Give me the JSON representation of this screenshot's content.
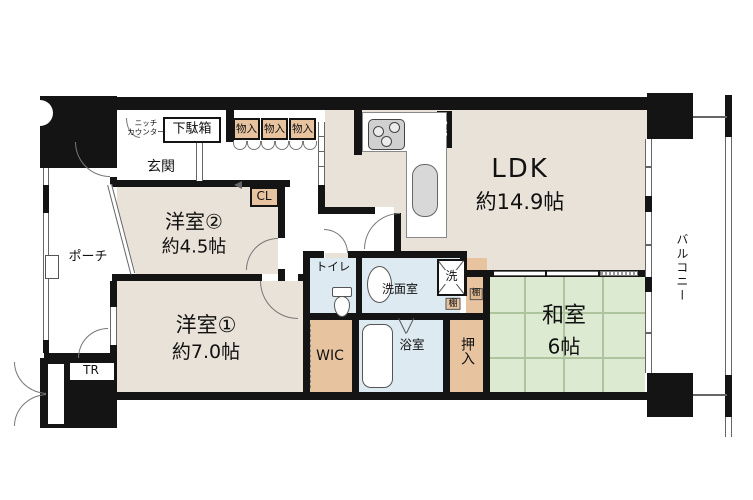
{
  "floorplan": {
    "rooms": {
      "ldk": {
        "label": "LDK",
        "area": "約14.9帖"
      },
      "western2": {
        "label": "洋室②",
        "area": "約4.5帖"
      },
      "western1": {
        "label": "洋室①",
        "area": "約7.0帖"
      },
      "japanese": {
        "label": "和室",
        "area": "6帖"
      }
    },
    "spaces": {
      "entrance": "玄関",
      "porch": "ポーチ",
      "balcony": "バルコニー",
      "toilet": "トイレ",
      "washroom": "洗面室",
      "bathroom": "浴室",
      "wic": "WIC",
      "closet": "CL",
      "oshiire": "押入",
      "shoe_cabinet": "下駄箱",
      "storage_1": "物入",
      "storage_2": "物入",
      "storage_3": "物入",
      "shelf_1": "棚",
      "shelf_2": "棚",
      "washer": "洗",
      "trunk_room": "TR",
      "pipe_space": "PS",
      "niche_counter_line1": "ニッチ",
      "niche_counter_line2": "カウンター"
    },
    "colors": {
      "wall": "#141414",
      "room_beige": "#e9e2d8",
      "storage_tan": "#e7c3a0",
      "wet_blue": "#ddeaf2",
      "tatami_green": "#dcead2"
    }
  }
}
